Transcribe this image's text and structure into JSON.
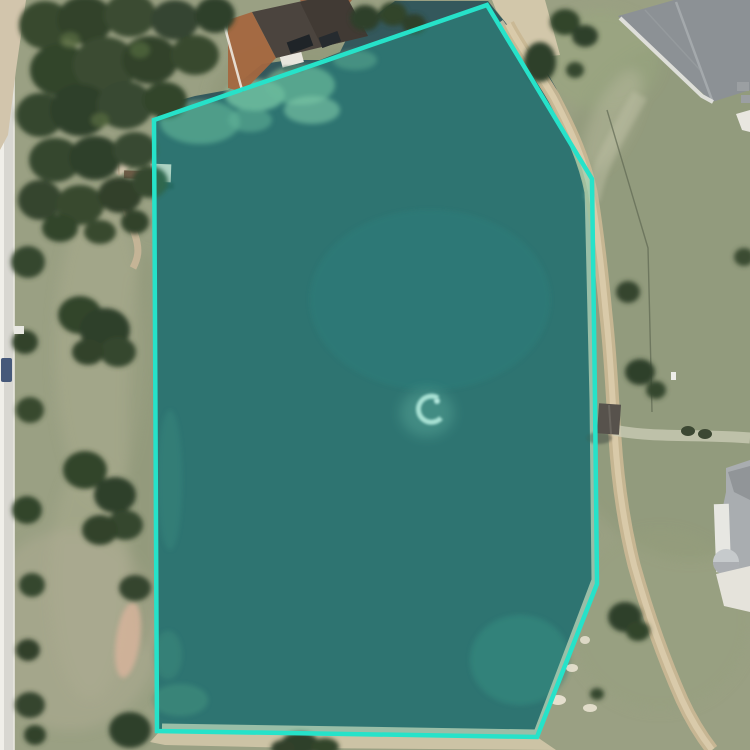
{
  "scene": {
    "type": "satellite-map-annotation-view",
    "description": "Aerial satellite imagery of a large pond outlined by a bright teal polygon annotation",
    "width": 750,
    "height": 750
  },
  "annotation": {
    "shape": "polygon",
    "points": "154,120 487,5 592,179 595,400 597,584 537,737 157,731",
    "stroke": "#26E2C9",
    "stroke_width": "4.5",
    "fill": "#1CD9BE",
    "fill_opacity": "0.22"
  },
  "palette": {
    "water": "#34585C",
    "grass": "#9AA083",
    "road": "#D8D7D1",
    "tree_dark": "#37482F",
    "sand": "#D5C8AB",
    "path_tan": "#C9B794",
    "algae_green": "#7FB090",
    "roof_dark_brown": "#4B443E",
    "roof_gray": "#8C9195",
    "roof_light_gray": "#A9ADB0",
    "brick": "#A4673F",
    "fountain_white": "#DFF0E6"
  },
  "features": {
    "pond": "pond",
    "fountain": "fountain-spray",
    "gazebo": "lakeside-gazebo",
    "west_dock": "west-dock",
    "north_dock": "north-dock",
    "shed": "shore-shed",
    "house_top": "house-top-center",
    "house_ne": "house-top-right",
    "house_se": "house-bottom-right",
    "road": "road-left",
    "shore_path": "east-shore-path"
  }
}
